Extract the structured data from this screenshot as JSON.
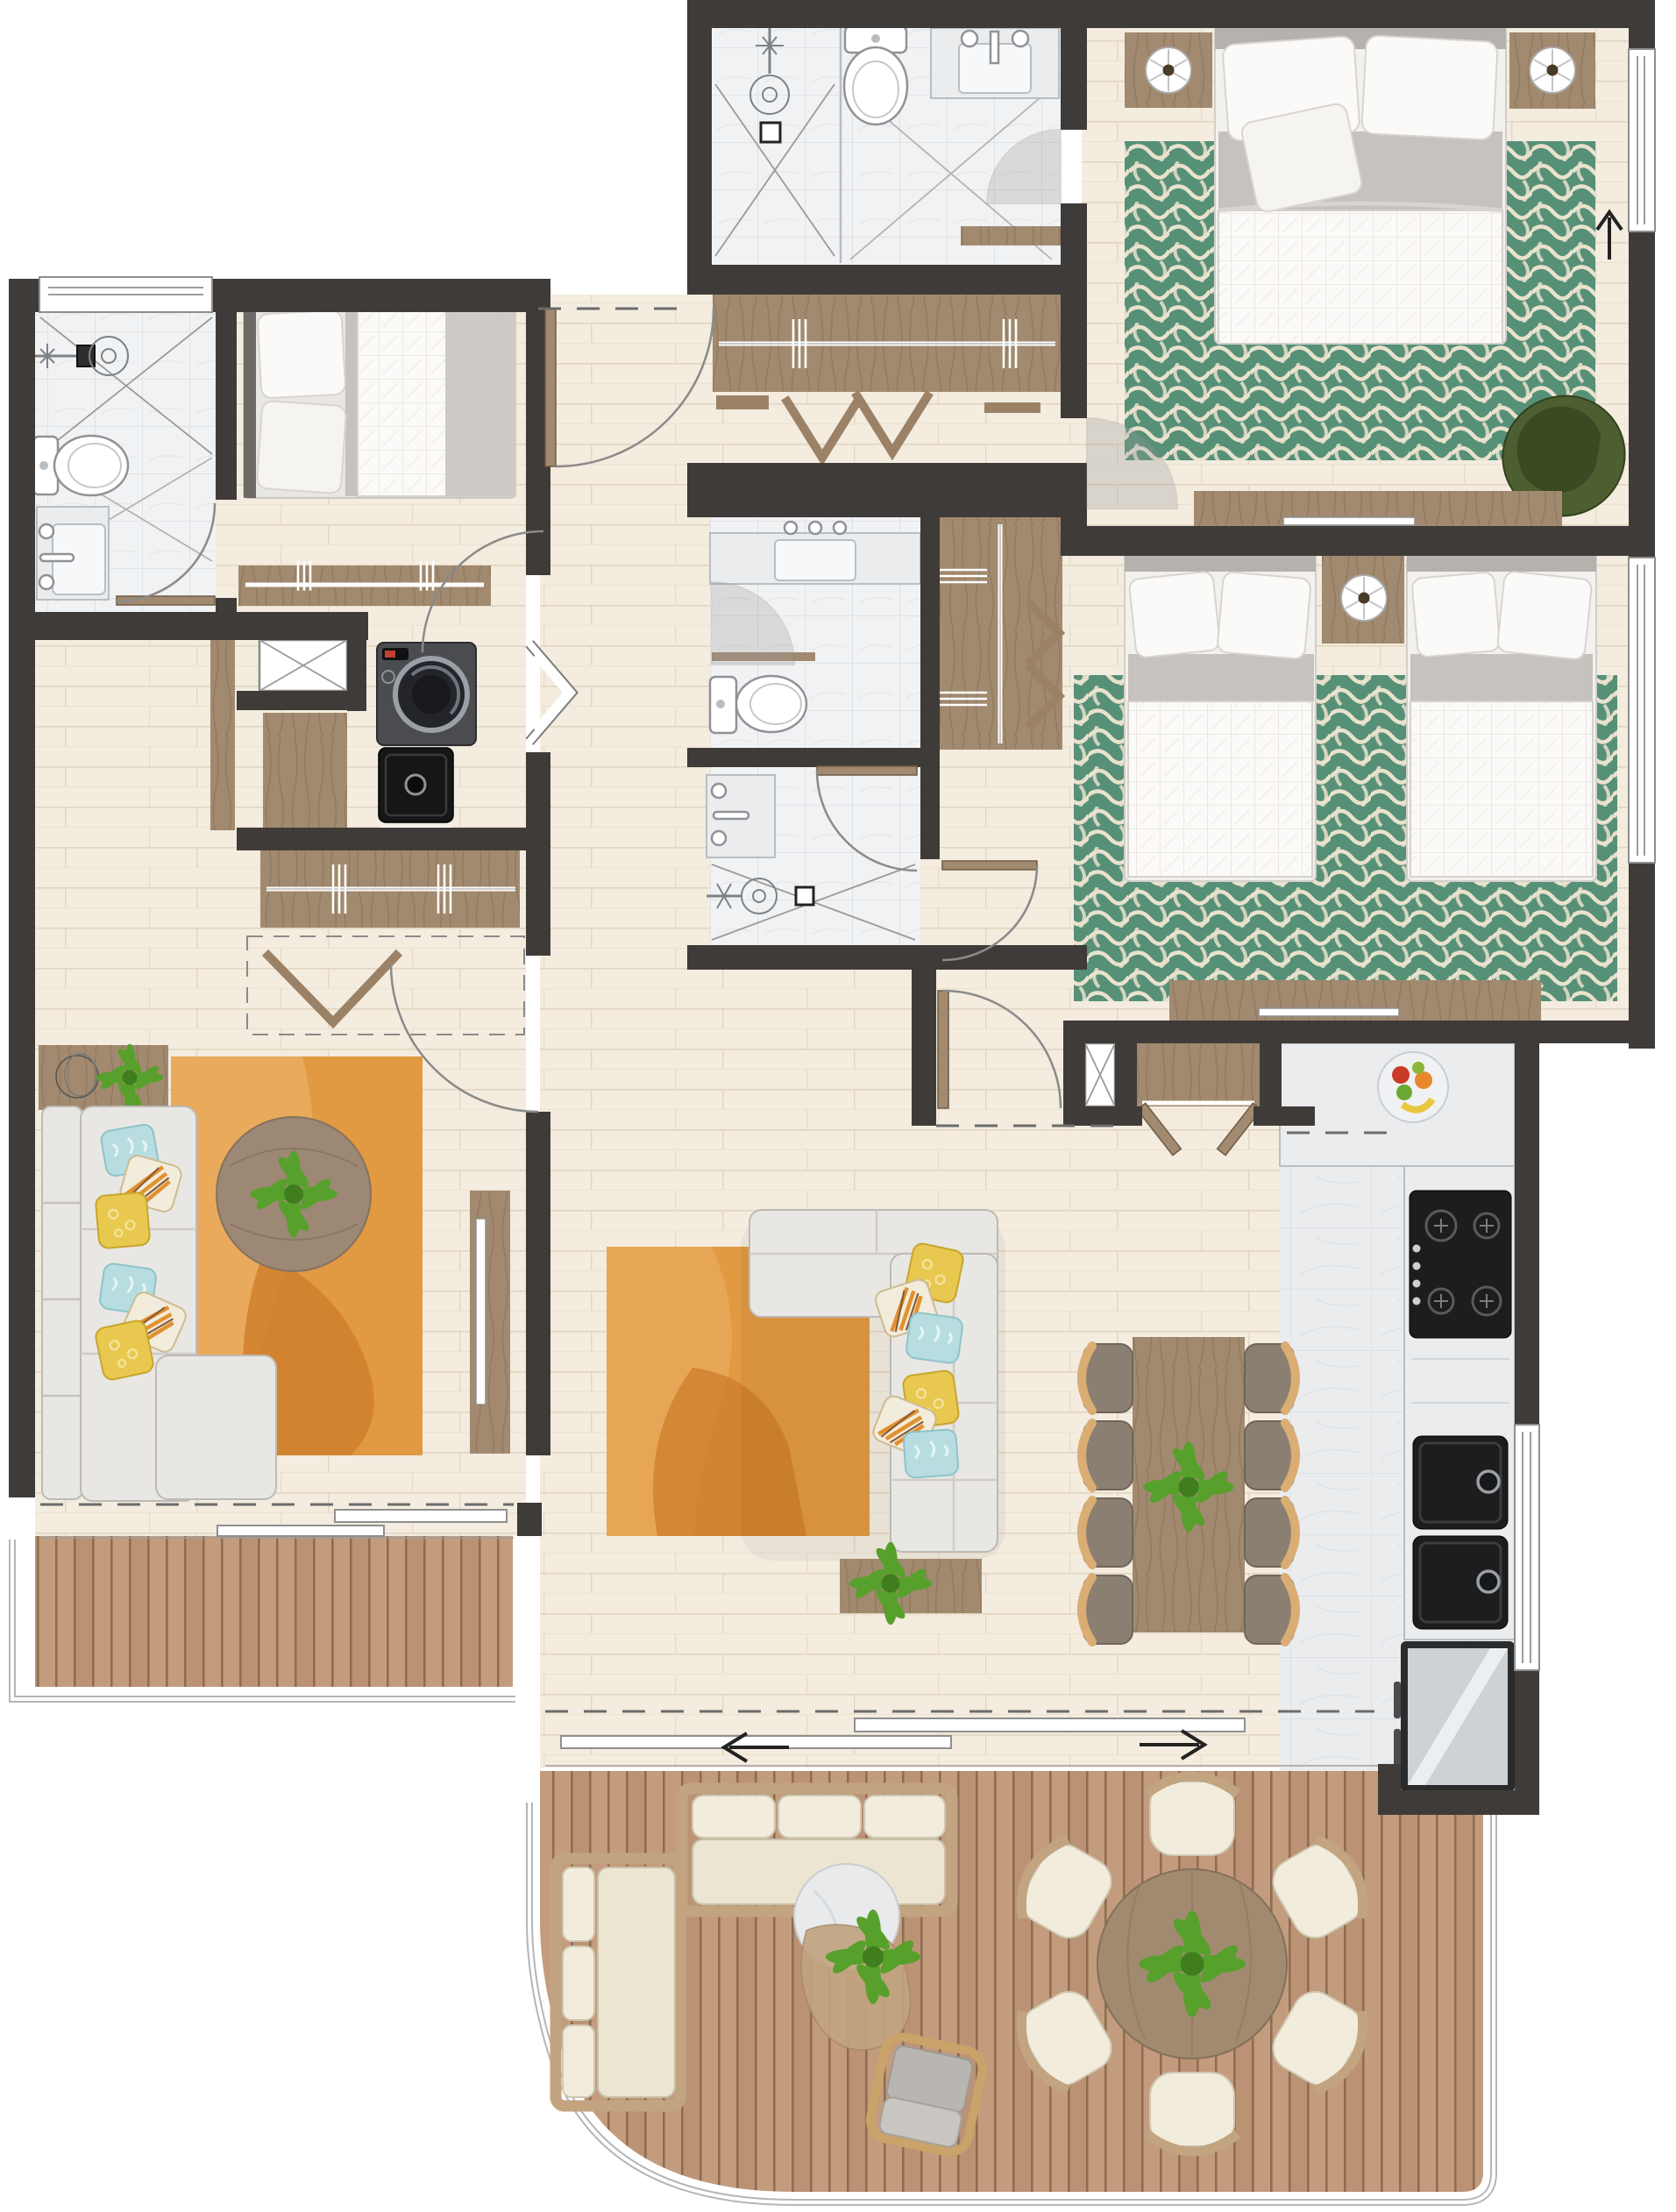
{
  "document": {
    "kind": "architectural floor plan, rendered top-down view",
    "units": "none shown",
    "visible_text": "none"
  },
  "palette": {
    "wall": "#3f3b38",
    "floor": "#f3ecdf",
    "floor_line": "#e3d5c1",
    "tile": "#f1f2f3",
    "tile_line": "#dbdee1",
    "marble": "#eaecee",
    "marble_line": "#d9dde1",
    "deck": "#c39c7d",
    "deck_seam": "#8f6c52",
    "deck_alt": "#bb9374",
    "rug_green": "#569077",
    "rug_green_pat": "#e9e2cd",
    "rug_orange": "#e19942",
    "rug_orange_dark": "#ce7d2b",
    "rug_orange_light": "#ecb167",
    "rug_circle": "#9c8874",
    "sofa": "#e8e7e4",
    "cushion": "#ece5d2",
    "cushion_light": "#f2ecdc",
    "wood": "#a18a6f",
    "wood_dark": "#876f56",
    "wood_light": "#c2a481",
    "closet": "#9b8266",
    "headboard": "#b5b1ad",
    "sheet": "#c6c2be",
    "teal": "#b7dde0",
    "yellow": "#e8c84e",
    "orange": "#e2912f",
    "green_chair": "#4d5f30",
    "green_chair_dark": "#3b4a23",
    "plant": "#57a02c",
    "plant_dark": "#3f7d1d",
    "black": "#1d1d1e",
    "steel": "#ccd2d6",
    "chair_taupe": "#8b7f71",
    "chair_arm": "#d9ad74",
    "line": "#9b9b9b",
    "arc": "#8a8a8a",
    "fruit_red": "#c93a28",
    "fruit_orange": "#e8872b",
    "fruit_yellow": "#e9c63f",
    "fruit_green": "#69a832"
  },
  "rooms": [
    {
      "name": "master-bedroom",
      "furniture": [
        "double-bed",
        "2 nightstands",
        "2 round lamps",
        "green patterned rug",
        "olive-green armchair",
        "media console with tv",
        "window",
        "north-arrow"
      ]
    },
    {
      "name": "master-bathroom",
      "furniture": [
        "walk-in shower",
        "toilet",
        "vanity sink",
        "glass partition"
      ]
    },
    {
      "name": "walk-in-closet",
      "furniture": [
        "sliding-door wardrobe",
        "hanger symbols",
        "bench"
      ]
    },
    {
      "name": "second-bedroom",
      "furniture": [
        "2 single beds",
        "shared nightstand with lamp",
        "green patterned rug",
        "media console with tv",
        "closet with rail",
        "window"
      ]
    },
    {
      "name": "hall-bathroom",
      "furniture": [
        "vanity sink",
        "toilet",
        "shelf"
      ]
    },
    {
      "name": "shower-room",
      "furniture": [
        "vanity sink",
        "walk-in shower with drain"
      ]
    },
    {
      "name": "third-bedroom",
      "furniture": [
        "single bed",
        "closet with rail"
      ]
    },
    {
      "name": "bathroom-3",
      "furniture": [
        "walk-in shower",
        "toilet",
        "vanity sink",
        "window"
      ]
    },
    {
      "name": "laundry",
      "furniture": [
        "washing machine",
        "black utility sink",
        "duct shaft",
        "cabinets",
        "bifold doors"
      ]
    },
    {
      "name": "family-room",
      "furniture": [
        "L-shaped sofa with pillows",
        "round coffee table with plant",
        "orange rug",
        "sideboard with plant and wire decor",
        "tv panel",
        "closet with rail",
        "dashed wardrobe with hangers"
      ]
    },
    {
      "name": "living-dining",
      "furniture": [
        "L-shaped sofa with pillows",
        "orange rug",
        "side table with plant",
        "dining table for 8 with centerpiece plant",
        "sliding doors with direction arrows"
      ]
    },
    {
      "name": "kitchen",
      "furniture": [
        "L-counter",
        "fruit bowl",
        "4-burner gas hob",
        "2 black sinks",
        "fridge",
        "pantry with bifold doors",
        "duct shaft",
        "window"
      ]
    },
    {
      "name": "entry-hall",
      "furniture": [
        "entry door"
      ]
    },
    {
      "name": "balcony",
      "furniture": [
        "wood deck",
        "railing"
      ]
    },
    {
      "name": "terrace",
      "furniture": [
        "wood deck",
        "outdoor 3-seat sofa",
        "outdoor 2-seat sofa",
        "pebble side table with plant",
        "wicker lounge chair",
        "round dining table with plant",
        "6 outdoor chairs",
        "curved railing"
      ]
    }
  ],
  "counts": {
    "bedrooms": 3,
    "bathrooms": 3,
    "dining_chairs": 8,
    "terrace_chairs": 6,
    "outdoor_sofas": 2,
    "sinks_kitchen": 2
  }
}
